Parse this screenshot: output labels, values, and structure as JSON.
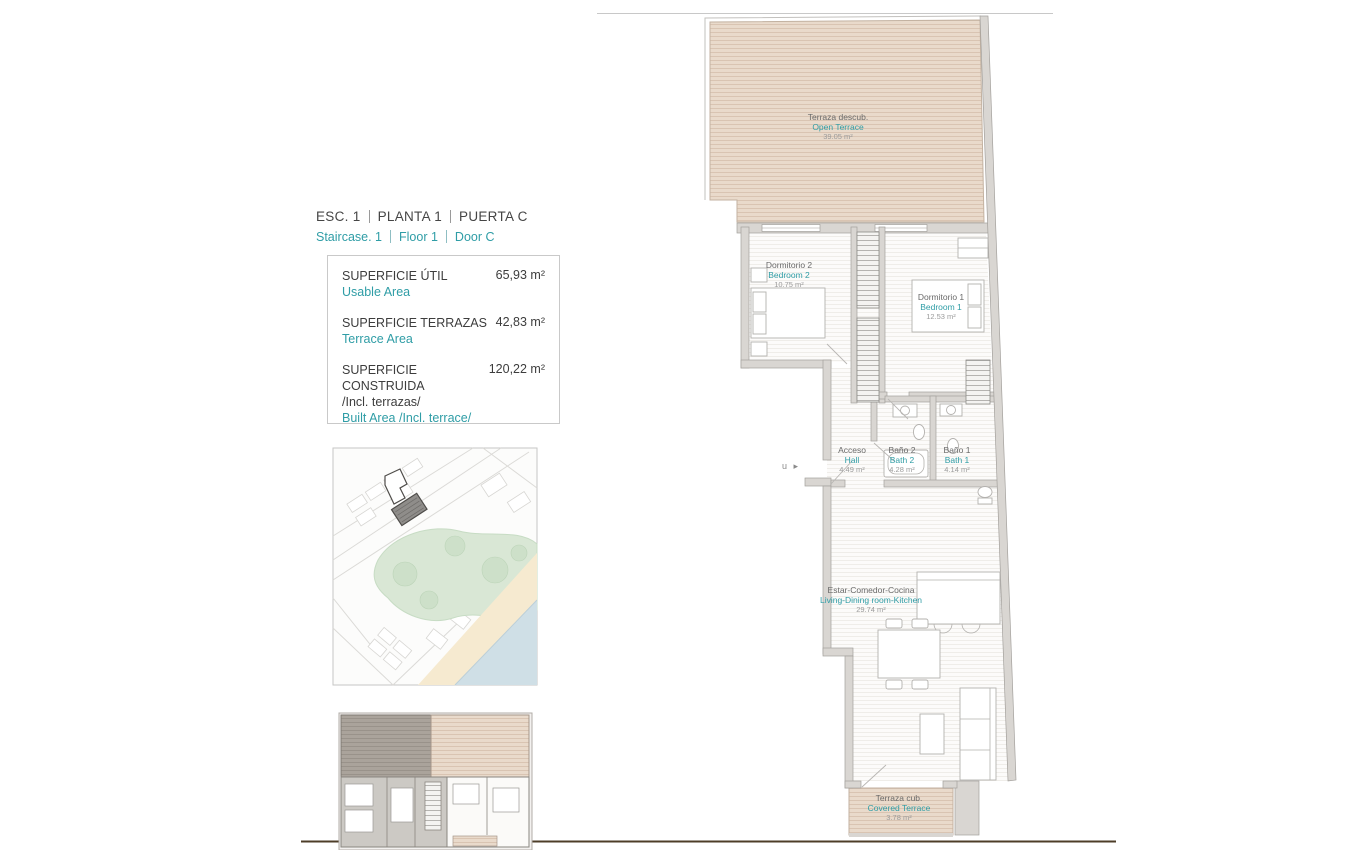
{
  "colors": {
    "accent": "#2F9DA6",
    "text_dark": "#3D3D3D"
  },
  "header": {
    "title_parts": [
      "ESC.  1",
      "PLANTA   1",
      "PUERTA C"
    ],
    "subtitle_parts": [
      "Staircase.  1",
      "Floor   1",
      "Door C"
    ]
  },
  "area_table": {
    "rows": [
      {
        "label_es": "SUPERFICIE ÚTIL",
        "label_es_extra": "",
        "label_en": "Usable Area",
        "value": "65,93 m²"
      },
      {
        "label_es": "SUPERFICIE TERRAZAS",
        "label_es_extra": "",
        "label_en": "Terrace Area",
        "value": "42,83 m²"
      },
      {
        "label_es": "SUPERFICIE CONSTRUIDA",
        "label_es_extra": "/Incl. terrazas/",
        "label_en": "Built Area /Incl. terrace/",
        "value": "120,22 m²"
      }
    ]
  },
  "plan": {
    "entrance_marker": "u ▸",
    "rooms": [
      {
        "name_es": "Terraza descub.",
        "name_en": "Open Terrace",
        "area": "39.05 m²"
      },
      {
        "name_es": "Dormitorio 2",
        "name_en": "Bedroom 2",
        "area": "10.75 m²"
      },
      {
        "name_es": "Dormitorio 1",
        "name_en": "Bedroom 1",
        "area": "12.53 m²"
      },
      {
        "name_es": "Acceso",
        "name_en": "Hall",
        "area": "4.49 m²"
      },
      {
        "name_es": "Baño 2",
        "name_en": "Bath 2",
        "area": "4.28 m²"
      },
      {
        "name_es": "Baño 1",
        "name_en": "Bath 1",
        "area": "4.14 m²"
      },
      {
        "name_es": "Estar-Comedor-Cocina",
        "name_en": "Living-Dining room-Kitchen",
        "area": "29.74 m²"
      },
      {
        "name_es": "Terraza cub.",
        "name_en": "Covered Terrace",
        "area": "3.78 m²"
      }
    ]
  }
}
